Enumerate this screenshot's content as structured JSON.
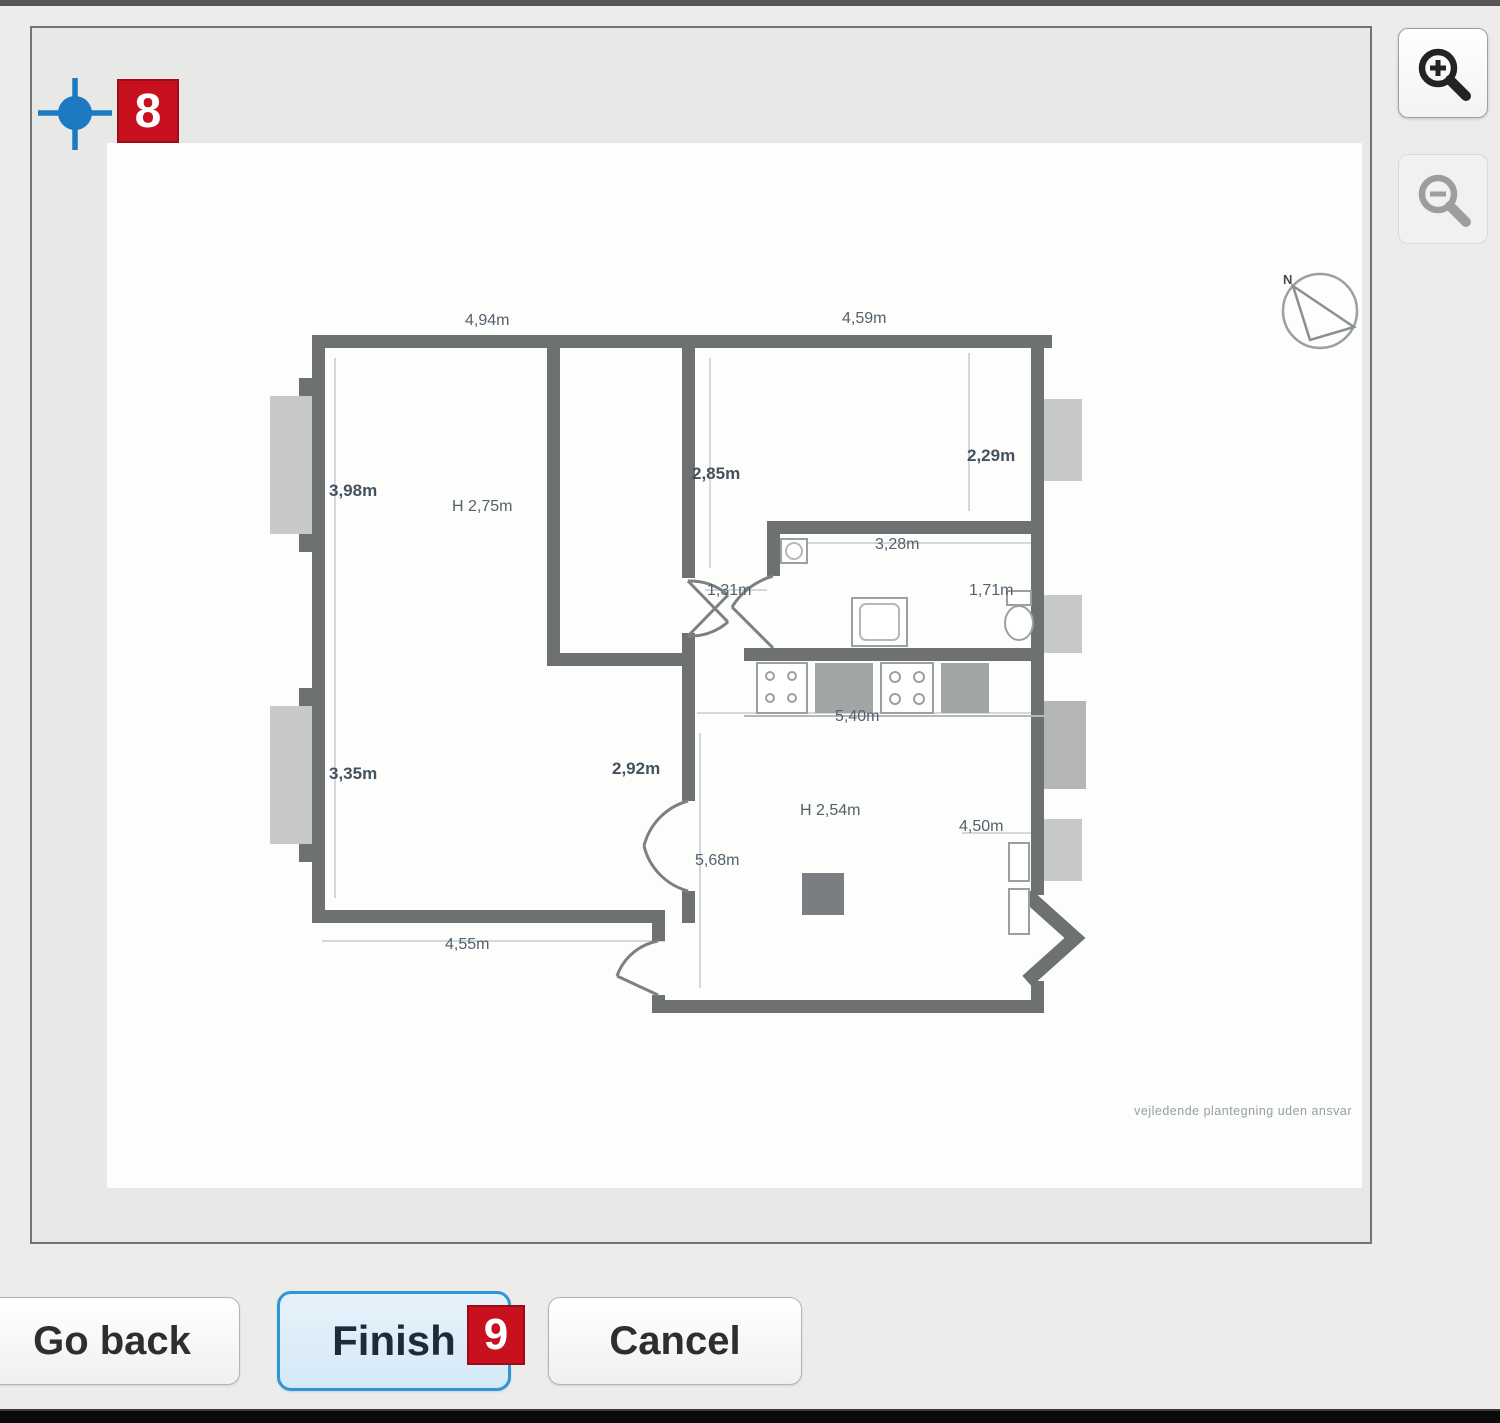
{
  "annotations": {
    "step8": "8",
    "step9": "9"
  },
  "buttons": {
    "go_back": "Go back",
    "finish": "Finish",
    "cancel": "Cancel"
  },
  "zoom_controls": {
    "zoom_in_icon": "magnifier-plus",
    "zoom_out_icon": "magnifier-minus"
  },
  "marker": {
    "type": "crosshair-point",
    "color": "#1b7ac2"
  },
  "floor_plan": {
    "compass_label": "N",
    "disclaimer": "vejledende plantegning uden ansvar",
    "dimensions": {
      "top_left": "4,94m",
      "top_right": "4,59m",
      "room1_width": "3,98m",
      "room1_height": "H 2,75m",
      "hall_width": "2,85m",
      "room2_width": "2,29m",
      "bath_width": "3,28m",
      "bath_depth": "1,71m",
      "hall_door": "1,31m",
      "kitchen_width": "5,40m",
      "room3_width": "2,92m",
      "room3_left": "3,35m",
      "living_height": "H 2,54m",
      "living_width": "4,50m",
      "living_length": "5,68m",
      "bottom_width": "4,55m"
    }
  },
  "colors": {
    "accent_blue": "#2e96d6",
    "marker_blue": "#1b7ac2",
    "badge_red": "#c8101f",
    "wall_gray": "#6e7172"
  }
}
